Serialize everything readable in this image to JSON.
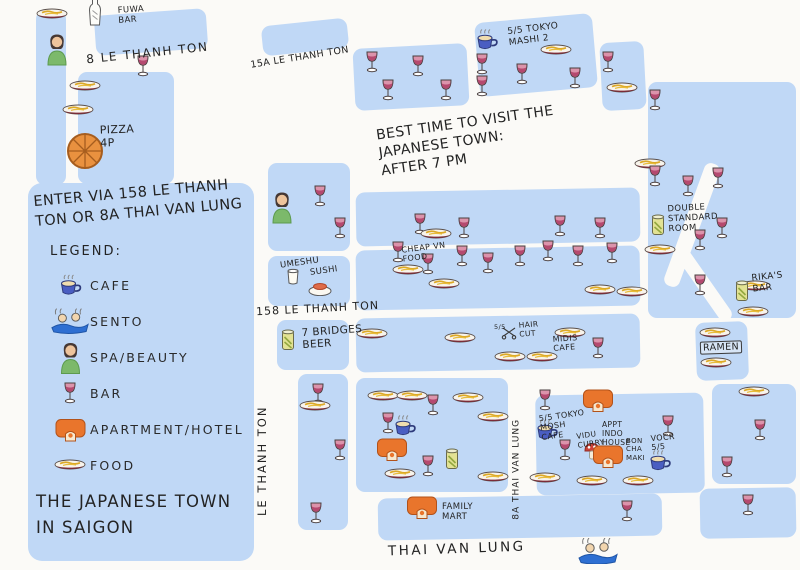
{
  "map": {
    "notes": {
      "entry": "ENTER VIA 158 LE THANH\nTON OR 8A THAI VAN LUNG",
      "best_time": "BEST TIME TO VISIT THE\nJAPANESE TOWN:\nAFTER 7 PM",
      "title": "THE JAPANESE TOWN\nIN SAIGON"
    },
    "legend": {
      "heading": "LEGEND:",
      "items": [
        {
          "type": "mug",
          "icon": "cafe-mug-icon",
          "label": "CAFE"
        },
        {
          "type": "sento",
          "icon": "sento-bath-icon",
          "label": "SENTO"
        },
        {
          "type": "spa",
          "icon": "spa-woman-icon",
          "label": "SPA/BEAUTY"
        },
        {
          "type": "wine",
          "icon": "wine-glass-icon",
          "label": "BAR"
        },
        {
          "type": "building",
          "icon": "apartment-icon",
          "label": "APARTMENT/HOTEL"
        },
        {
          "type": "plate",
          "icon": "food-plate-icon",
          "label": "FOOD"
        }
      ]
    },
    "streets": {
      "s8": "8 LE THANH TON",
      "s15a": "15A LE THANH TON",
      "s158": "158 LE THANH TON",
      "le_thanh_ton": "LE THANH TON",
      "s8a": "8A THAI VAN LUNG",
      "thai_van_lung": "THAI VAN LUNG"
    },
    "places": {
      "fuwa_bar": "FUWA\nBAR",
      "pizza_4p": "PIZZA\n4P",
      "tokyo_mashi_2": "5/5 TOKYO\nMASHI 2",
      "umeshu": "UMESHU",
      "sushi": "SUSHI",
      "seven_bridges_beer": "7 BRIDGES\nBEER",
      "cheap_vn_food": "CHEAP VN\nFOOD",
      "double_standard_room": "DOUBLE\nSTANDARD\nROOM",
      "rikas_bar": "RIKA'S\nBAR",
      "ramen": "RAMEN",
      "hair_cut_score": "5/5",
      "hair_cut": "HAIR\nCUT",
      "midis_cafe": "MIDIS\nCAFE",
      "tokyo_mosh_cafe": "5/5 TOKYO\nMOSH\nCAFE",
      "vidu_curry": "VIDU\nCURRY",
      "appt_indo_house": "APPT\nINDO\nHOUSE",
      "bon_cha_maki": "BON\nCHA\nMAKI",
      "vocr": "VOCR\n5/5",
      "family_mart": "FAMILY\nMART"
    },
    "markers": [
      {
        "t": "bottle",
        "x": 95,
        "y": 12
      },
      {
        "t": "plate",
        "x": 52,
        "y": 14
      },
      {
        "t": "spa",
        "x": 57,
        "y": 49
      },
      {
        "t": "wine",
        "x": 143,
        "y": 66
      },
      {
        "t": "plate",
        "x": 85,
        "y": 86
      },
      {
        "t": "plate",
        "x": 78,
        "y": 110
      },
      {
        "t": "pizza",
        "x": 85,
        "y": 151
      },
      {
        "t": "wine",
        "x": 372,
        "y": 62
      },
      {
        "t": "wine",
        "x": 418,
        "y": 66
      },
      {
        "t": "wine",
        "x": 388,
        "y": 90
      },
      {
        "t": "wine",
        "x": 446,
        "y": 90
      },
      {
        "t": "mug",
        "x": 487,
        "y": 40
      },
      {
        "t": "plate",
        "x": 556,
        "y": 50
      },
      {
        "t": "wine",
        "x": 482,
        "y": 64
      },
      {
        "t": "wine",
        "x": 482,
        "y": 86
      },
      {
        "t": "wine",
        "x": 522,
        "y": 74
      },
      {
        "t": "wine",
        "x": 575,
        "y": 78
      },
      {
        "t": "wine",
        "x": 608,
        "y": 62
      },
      {
        "t": "plate",
        "x": 622,
        "y": 88
      },
      {
        "t": "wine",
        "x": 655,
        "y": 100
      },
      {
        "t": "plate",
        "x": 650,
        "y": 164
      },
      {
        "t": "wine",
        "x": 655,
        "y": 176
      },
      {
        "t": "wine",
        "x": 688,
        "y": 186
      },
      {
        "t": "wine",
        "x": 718,
        "y": 178
      },
      {
        "t": "can",
        "x": 658,
        "y": 225
      },
      {
        "t": "wine",
        "x": 722,
        "y": 228
      },
      {
        "t": "wine",
        "x": 700,
        "y": 240
      },
      {
        "t": "plate",
        "x": 660,
        "y": 250
      },
      {
        "t": "wine",
        "x": 700,
        "y": 285
      },
      {
        "t": "plate",
        "x": 755,
        "y": 286
      },
      {
        "t": "can",
        "x": 742,
        "y": 291
      },
      {
        "t": "plate",
        "x": 753,
        "y": 312
      },
      {
        "t": "spa",
        "x": 282,
        "y": 207
      },
      {
        "t": "wine",
        "x": 320,
        "y": 196
      },
      {
        "t": "wine",
        "x": 340,
        "y": 228
      },
      {
        "t": "wine",
        "x": 420,
        "y": 224
      },
      {
        "t": "plate",
        "x": 436,
        "y": 234
      },
      {
        "t": "wine",
        "x": 464,
        "y": 228
      },
      {
        "t": "wine",
        "x": 560,
        "y": 226
      },
      {
        "t": "wine",
        "x": 600,
        "y": 228
      },
      {
        "t": "umeshu",
        "x": 293,
        "y": 277
      },
      {
        "t": "sushi",
        "x": 320,
        "y": 289
      },
      {
        "t": "wine",
        "x": 398,
        "y": 252
      },
      {
        "t": "wine",
        "x": 428,
        "y": 264
      },
      {
        "t": "wine",
        "x": 462,
        "y": 256
      },
      {
        "t": "wine",
        "x": 488,
        "y": 263
      },
      {
        "t": "wine",
        "x": 520,
        "y": 256
      },
      {
        "t": "wine",
        "x": 548,
        "y": 251
      },
      {
        "t": "wine",
        "x": 578,
        "y": 256
      },
      {
        "t": "wine",
        "x": 612,
        "y": 253
      },
      {
        "t": "plate",
        "x": 408,
        "y": 270
      },
      {
        "t": "plate",
        "x": 444,
        "y": 284
      },
      {
        "t": "plate",
        "x": 600,
        "y": 290
      },
      {
        "t": "plate",
        "x": 632,
        "y": 292
      },
      {
        "t": "can",
        "x": 288,
        "y": 340
      },
      {
        "t": "plate",
        "x": 372,
        "y": 334
      },
      {
        "t": "plate",
        "x": 460,
        "y": 338
      },
      {
        "t": "scissors",
        "x": 509,
        "y": 333
      },
      {
        "t": "plate",
        "x": 570,
        "y": 333
      },
      {
        "t": "plate",
        "x": 510,
        "y": 357
      },
      {
        "t": "plate",
        "x": 542,
        "y": 357
      },
      {
        "t": "wine",
        "x": 598,
        "y": 348
      },
      {
        "t": "plate",
        "x": 715,
        "y": 333
      },
      {
        "t": "plate",
        "x": 716,
        "y": 363
      },
      {
        "t": "wine",
        "x": 318,
        "y": 394
      },
      {
        "t": "plate",
        "x": 315,
        "y": 406
      },
      {
        "t": "wine",
        "x": 340,
        "y": 450
      },
      {
        "t": "wine",
        "x": 316,
        "y": 513
      },
      {
        "t": "plate",
        "x": 383,
        "y": 396
      },
      {
        "t": "plate",
        "x": 412,
        "y": 396
      },
      {
        "t": "wine",
        "x": 433,
        "y": 405
      },
      {
        "t": "plate",
        "x": 468,
        "y": 398
      },
      {
        "t": "plate",
        "x": 493,
        "y": 417
      },
      {
        "t": "wine",
        "x": 388,
        "y": 423
      },
      {
        "t": "mug",
        "x": 405,
        "y": 426
      },
      {
        "t": "building",
        "x": 392,
        "y": 449
      },
      {
        "t": "can",
        "x": 452,
        "y": 459
      },
      {
        "t": "wine",
        "x": 428,
        "y": 466
      },
      {
        "t": "plate",
        "x": 400,
        "y": 474
      },
      {
        "t": "plate",
        "x": 493,
        "y": 477
      },
      {
        "t": "wine",
        "x": 545,
        "y": 400
      },
      {
        "t": "building",
        "x": 598,
        "y": 400
      },
      {
        "t": "mug",
        "x": 547,
        "y": 430
      },
      {
        "t": "wine",
        "x": 565,
        "y": 450
      },
      {
        "t": "mushroom",
        "x": 592,
        "y": 451
      },
      {
        "t": "building",
        "x": 608,
        "y": 456
      },
      {
        "t": "mug",
        "x": 660,
        "y": 461
      },
      {
        "t": "wine",
        "x": 668,
        "y": 426
      },
      {
        "t": "plate",
        "x": 545,
        "y": 478
      },
      {
        "t": "plate",
        "x": 592,
        "y": 481
      },
      {
        "t": "plate",
        "x": 638,
        "y": 481
      },
      {
        "t": "plate",
        "x": 754,
        "y": 392
      },
      {
        "t": "wine",
        "x": 760,
        "y": 430
      },
      {
        "t": "wine",
        "x": 727,
        "y": 467
      },
      {
        "t": "wine",
        "x": 748,
        "y": 505
      },
      {
        "t": "building",
        "x": 422,
        "y": 507
      },
      {
        "t": "wine",
        "x": 627,
        "y": 511
      },
      {
        "t": "sento",
        "x": 598,
        "y": 551
      }
    ]
  }
}
